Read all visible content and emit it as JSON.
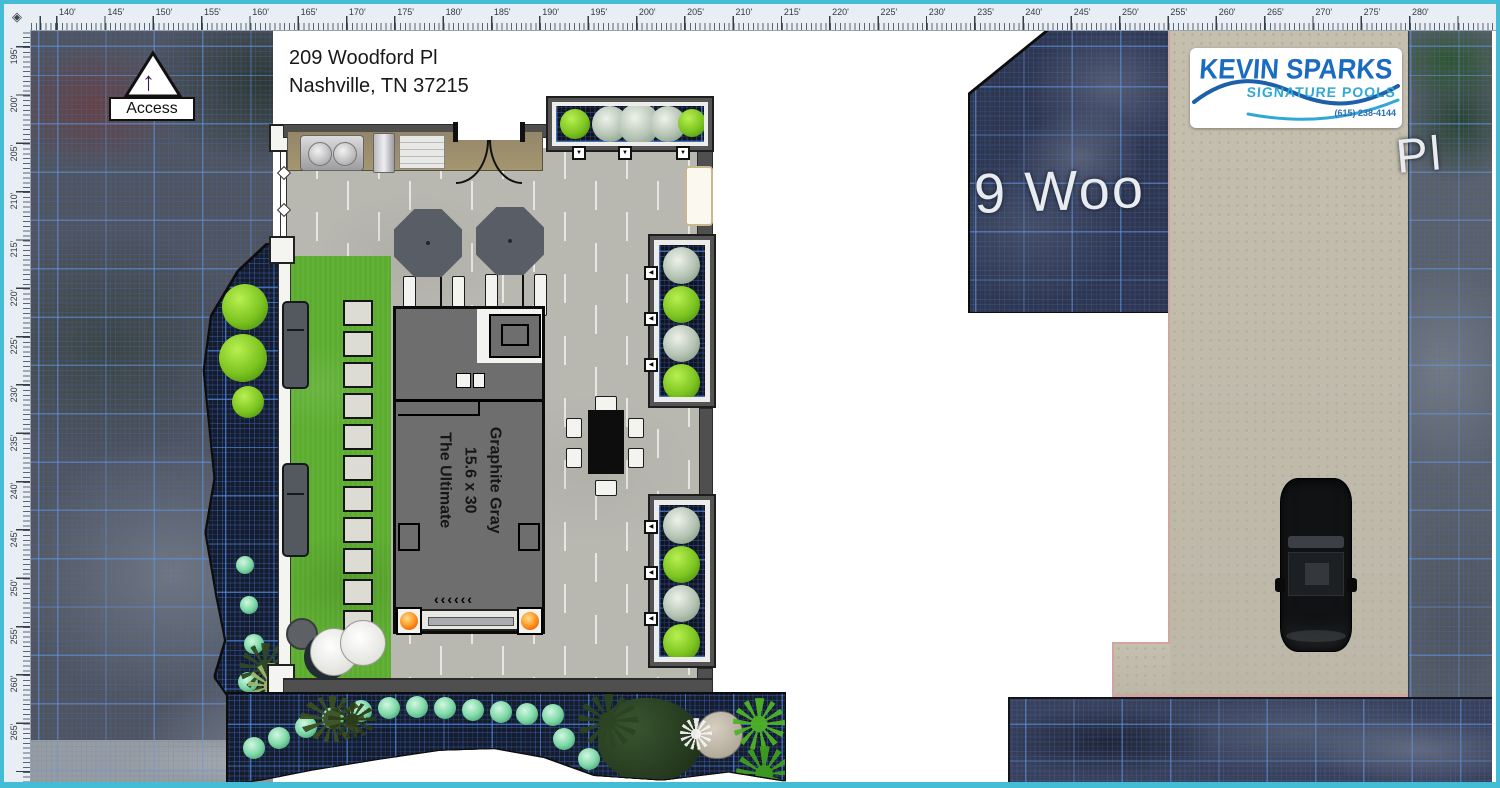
{
  "app": {
    "view": "pool-landscape-plan-2d"
  },
  "rulers": {
    "top": {
      "labels": [
        "140'",
        "145'",
        "150'",
        "155'",
        "160'",
        "165'",
        "170'",
        "175'",
        "180'",
        "185'",
        "190'",
        "195'",
        "200'",
        "205'",
        "210'",
        "215'",
        "220'",
        "225'",
        "230'",
        "235'",
        "240'",
        "245'",
        "250'",
        "255'",
        "260'",
        "265'",
        "270'",
        "275'",
        "280'"
      ]
    },
    "left": {
      "labels": [
        "195'",
        "200'",
        "205'",
        "210'",
        "215'",
        "220'",
        "225'",
        "230'",
        "235'",
        "240'",
        "245'",
        "250'",
        "255'",
        "260'",
        "265'"
      ]
    }
  },
  "access_label": "Access",
  "address": {
    "line1": "209 Woodford Pl",
    "line2": "Nashville, TN 37215"
  },
  "pool": {
    "label_lines": [
      "Graphite Gray",
      "15.6 x 30",
      "The Ultimate"
    ]
  },
  "map_labels": {
    "street_partial_left": "9 Woo",
    "street_partial_right": "Pl"
  },
  "logo": {
    "company_line1": "KEVIN SPARKS",
    "company_line2": "SIGNATURE POOLS",
    "phone": "(615) 238-4144"
  },
  "icons": {
    "north_arrow": "↑",
    "sprinkler_down": "▼",
    "sprinkler_left": "◀",
    "pool_steps_chevrons": "‹‹‹‹‹‹",
    "corner_diamond": "◈"
  },
  "colors": {
    "frame_cyan": "#43bcd6",
    "grid_blue": "#5f96e6",
    "pool_graphite": "#6e6e6e",
    "lawn_green": "#5cad2f",
    "driveway_beige": "#cbc5b5",
    "driveway_curb_rose": "#d2a49e",
    "logo_blue_dark": "#1b6cc0",
    "logo_blue_light": "#31a9d6",
    "pool_light_orange": "#ff8c1a"
  }
}
